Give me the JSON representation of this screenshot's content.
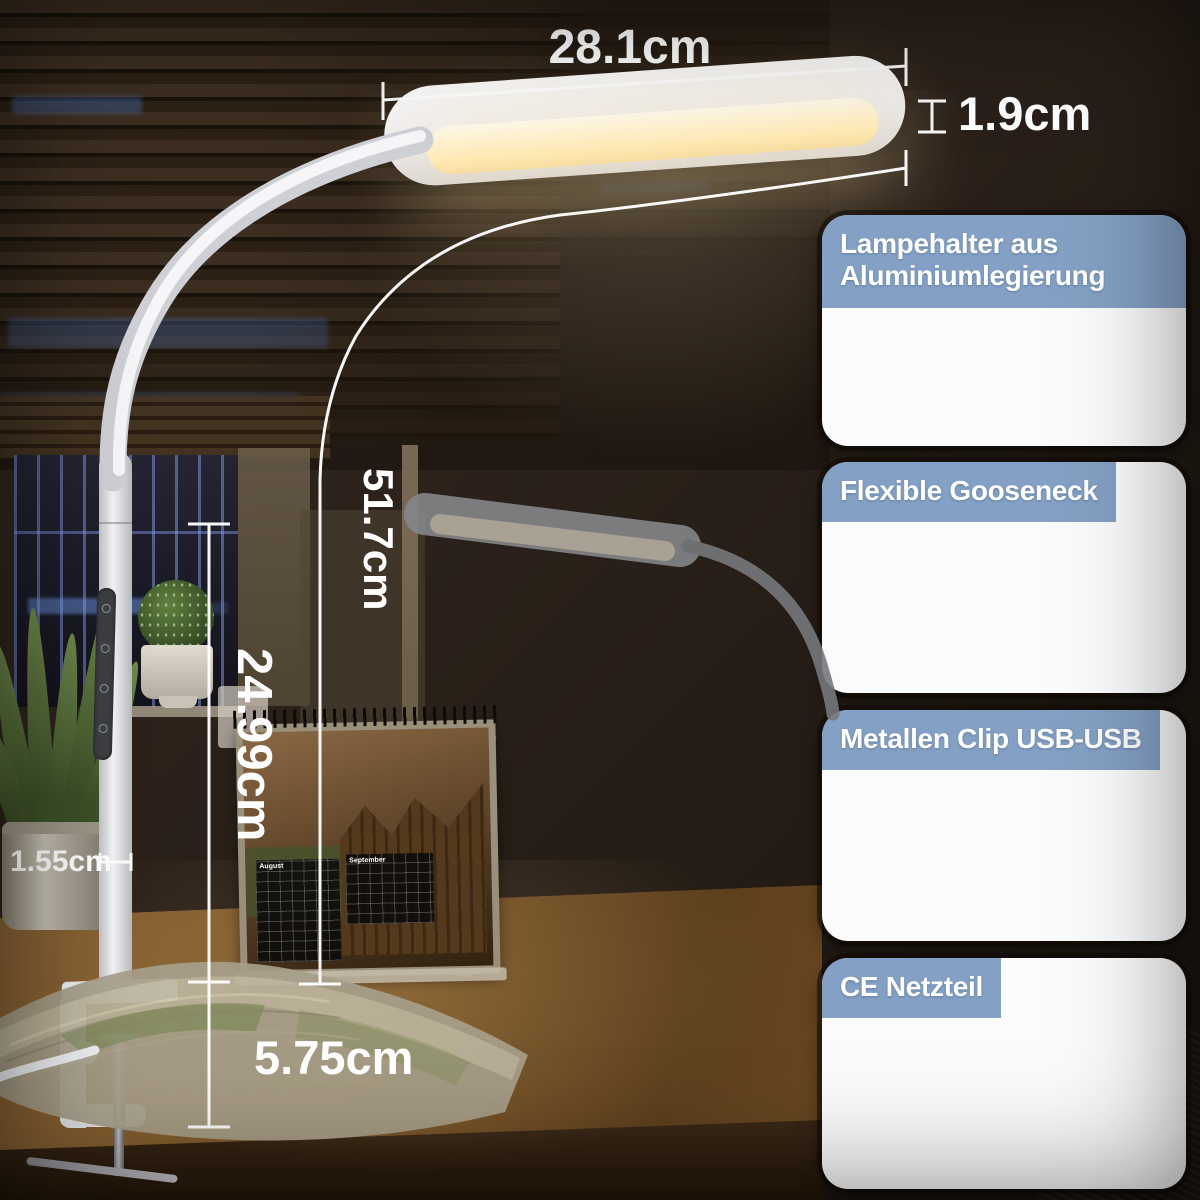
{
  "product_scene": {
    "dimensions": {
      "head_width": {
        "label": "28.1cm",
        "orientation": "horizontal"
      },
      "head_thickness": {
        "label": "1.9cm",
        "orientation": "horizontal"
      },
      "overall_height": {
        "label": "51.7cm",
        "orientation": "vertical"
      },
      "pole_height": {
        "label": "24.99cm",
        "orientation": "vertical"
      },
      "pole_diameter": {
        "label": "1.55cm",
        "orientation": "horizontal"
      },
      "clamp_opening": {
        "label": "5.75cm",
        "orientation": "horizontal"
      }
    },
    "calendar_months": [
      "August",
      "September"
    ]
  },
  "feature_panels": [
    {
      "caption": "Lampehalter aus Aluminiumlegierung",
      "photo_icon": "lamp-head-photo"
    },
    {
      "caption": "Flexible Gooseneck",
      "photo_icon": "gooseneck-photo"
    },
    {
      "caption": "Metallen Clip USB-USB",
      "photo_icon": "desk-clamp-photo"
    },
    {
      "caption": "CE Netzteil",
      "photo_icon": "power-adapter-photo"
    }
  ],
  "colors": {
    "caption_band": "#84a0c4",
    "dimension_text": "#ffffff",
    "lamp_glow": "#ffe9b4",
    "background": "#2b211a"
  }
}
